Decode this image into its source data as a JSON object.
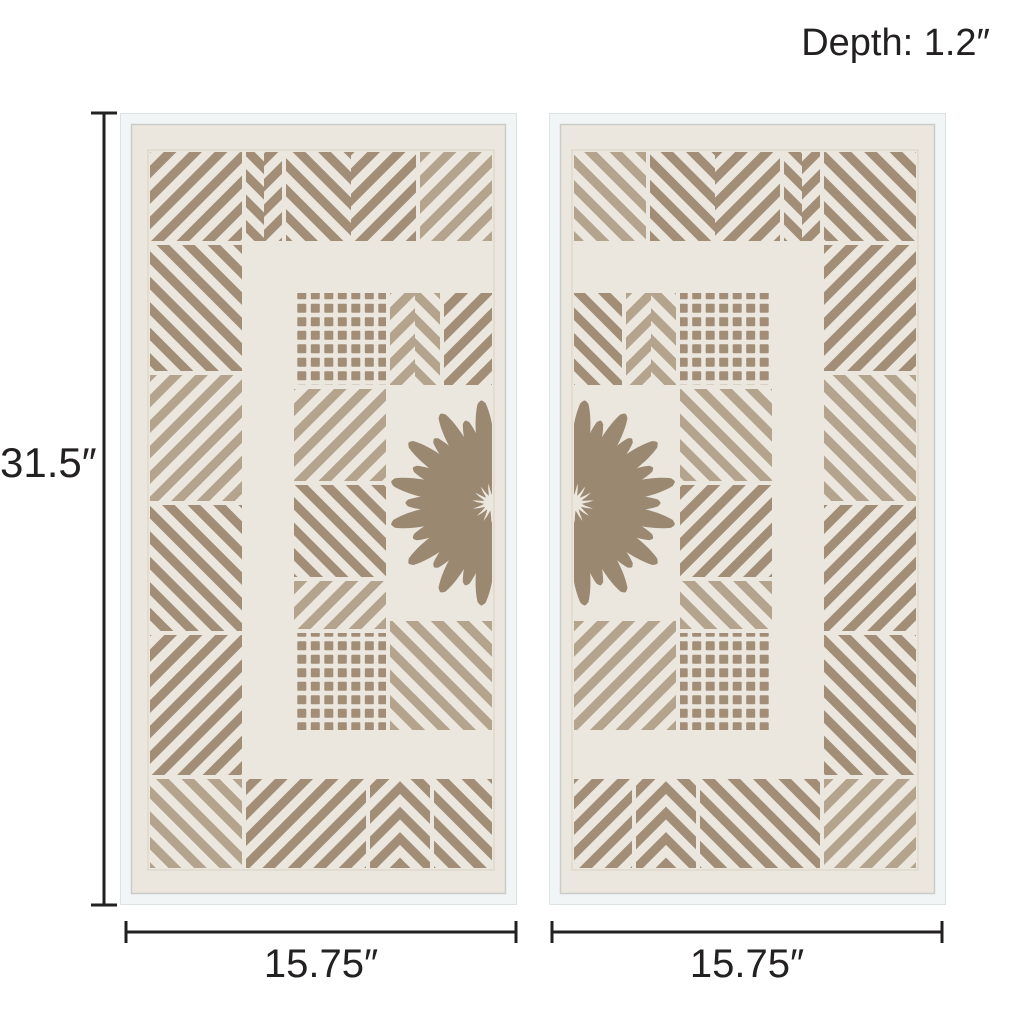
{
  "page": {
    "background": "#ffffff"
  },
  "annotations": {
    "depth_label": "Depth: 1.2″",
    "height_label": "31.5″",
    "width_left_label": "15.75″",
    "width_right_label": "15.75″",
    "line_color": "#232021",
    "text_color": "#232021"
  },
  "artwork": {
    "panel_count": 2,
    "colors": {
      "frame": "#f2f5f5",
      "frame_edge": "#dde2e2",
      "rabbet": "#c9cdc9",
      "paper": "#ebe7de",
      "cutout": "#a28e77",
      "cutout_light": "#b4a48d",
      "burst": "#9a8871",
      "pattern_border": "#d9d2c4"
    }
  }
}
